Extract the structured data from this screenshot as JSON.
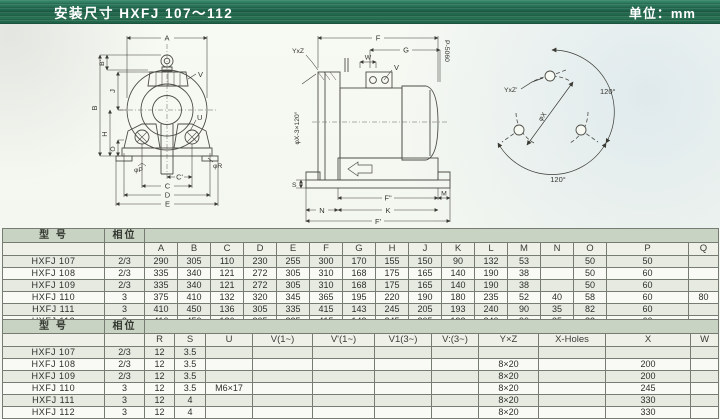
{
  "title_bar": {
    "title": "安装尺寸 HXFJ 107～112",
    "unit": "单位：mm"
  },
  "colors": {
    "titlebar_green": "#1e6149",
    "header_band": "#c9d3c3",
    "row_odd": "#e6eae1",
    "row_even": "#f9faf5"
  },
  "drawings": {
    "front": {
      "a": "A",
      "b_prime": "B'",
      "j": "J",
      "b": "B",
      "h": "H",
      "o": "O",
      "v": "V",
      "u": "U",
      "phi_p": "φP",
      "phi_r": "φR",
      "c_prime": "C'",
      "c": "C",
      "d": "D",
      "e": "E"
    },
    "side": {
      "f": "F",
      "g": "G",
      "w": "W",
      "v": "V",
      "p_hz": "P-5060",
      "yxz": "YxZ",
      "phi_x3": "φX-3×120°",
      "s": "S",
      "f_dprime": "F\"",
      "m": "M",
      "n": "N",
      "k": "K",
      "f_prime": "F'"
    },
    "flange": {
      "yxz": "YxZ'",
      "deg_right": "120°",
      "deg_bottom": "120°",
      "phi_x": "φX"
    }
  },
  "table1": {
    "model_header": "型 号",
    "phase_header": "相位",
    "dim_headers": [
      "A",
      "B",
      "C",
      "D",
      "E",
      "F",
      "G",
      "H",
      "J",
      "K",
      "L",
      "M",
      "N",
      "O",
      "P",
      "Q"
    ],
    "rows": [
      {
        "model": "HXFJ 107",
        "phase": "2/3",
        "values": [
          "290",
          "305",
          "110",
          "230",
          "255",
          "300",
          "170",
          "155",
          "150",
          "90",
          "132",
          "53",
          "",
          "50",
          "50",
          ""
        ]
      },
      {
        "model": "HXFJ 108",
        "phase": "2/3",
        "values": [
          "335",
          "340",
          "121",
          "272",
          "305",
          "310",
          "168",
          "175",
          "165",
          "140",
          "190",
          "38",
          "",
          "50",
          "60",
          ""
        ]
      },
      {
        "model": "HXFJ 109",
        "phase": "2/3",
        "values": [
          "335",
          "340",
          "121",
          "272",
          "305",
          "310",
          "168",
          "175",
          "165",
          "140",
          "190",
          "38",
          "",
          "50",
          "60",
          ""
        ]
      },
      {
        "model": "HXFJ 110",
        "phase": "3",
        "values": [
          "375",
          "410",
          "132",
          "320",
          "345",
          "365",
          "195",
          "220",
          "190",
          "180",
          "235",
          "52",
          "40",
          "58",
          "60",
          "80"
        ]
      },
      {
        "model": "HXFJ 111",
        "phase": "3",
        "values": [
          "410",
          "450",
          "136",
          "305",
          "335",
          "415",
          "143",
          "245",
          "205",
          "193",
          "240",
          "90",
          "35",
          "82",
          "60",
          ""
        ]
      },
      {
        "model": "HXFJ 112",
        "phase": "3",
        "values": [
          "410",
          "450",
          "136",
          "305",
          "335",
          "415",
          "143",
          "245",
          "205",
          "193",
          "240",
          "90",
          "35",
          "82",
          "60",
          ""
        ]
      }
    ]
  },
  "table2": {
    "model_header": "型 号",
    "phase_header": "相位",
    "dim_headers": [
      "R",
      "S",
      "U",
      "V(1~)",
      "V'(1~)",
      "V1(3~)",
      "V:(3~)",
      "Y×Z",
      "X-Holes",
      "X",
      "W"
    ],
    "rows": [
      {
        "model": "HXFJ 107",
        "phase": "2/3",
        "values": [
          "12",
          "3.5",
          "",
          "",
          "",
          "",
          "",
          "",
          "",
          "",
          ""
        ]
      },
      {
        "model": "HXFJ 108",
        "phase": "2/3",
        "values": [
          "12",
          "3.5",
          "",
          "",
          "",
          "",
          "",
          "8×20",
          "",
          "200",
          ""
        ]
      },
      {
        "model": "HXFJ 109",
        "phase": "2/3",
        "values": [
          "12",
          "3.5",
          "",
          "",
          "",
          "",
          "",
          "8×20",
          "",
          "200",
          ""
        ]
      },
      {
        "model": "HXFJ 110",
        "phase": "3",
        "values": [
          "12",
          "3.5",
          "M6×17",
          "",
          "",
          "",
          "",
          "8×20",
          "",
          "245",
          ""
        ]
      },
      {
        "model": "HXFJ 111",
        "phase": "3",
        "values": [
          "12",
          "4",
          "",
          "",
          "",
          "",
          "",
          "8×20",
          "",
          "330",
          ""
        ]
      },
      {
        "model": "HXFJ 112",
        "phase": "3",
        "values": [
          "12",
          "4",
          "",
          "",
          "",
          "",
          "",
          "8×20",
          "",
          "330",
          ""
        ]
      }
    ]
  }
}
